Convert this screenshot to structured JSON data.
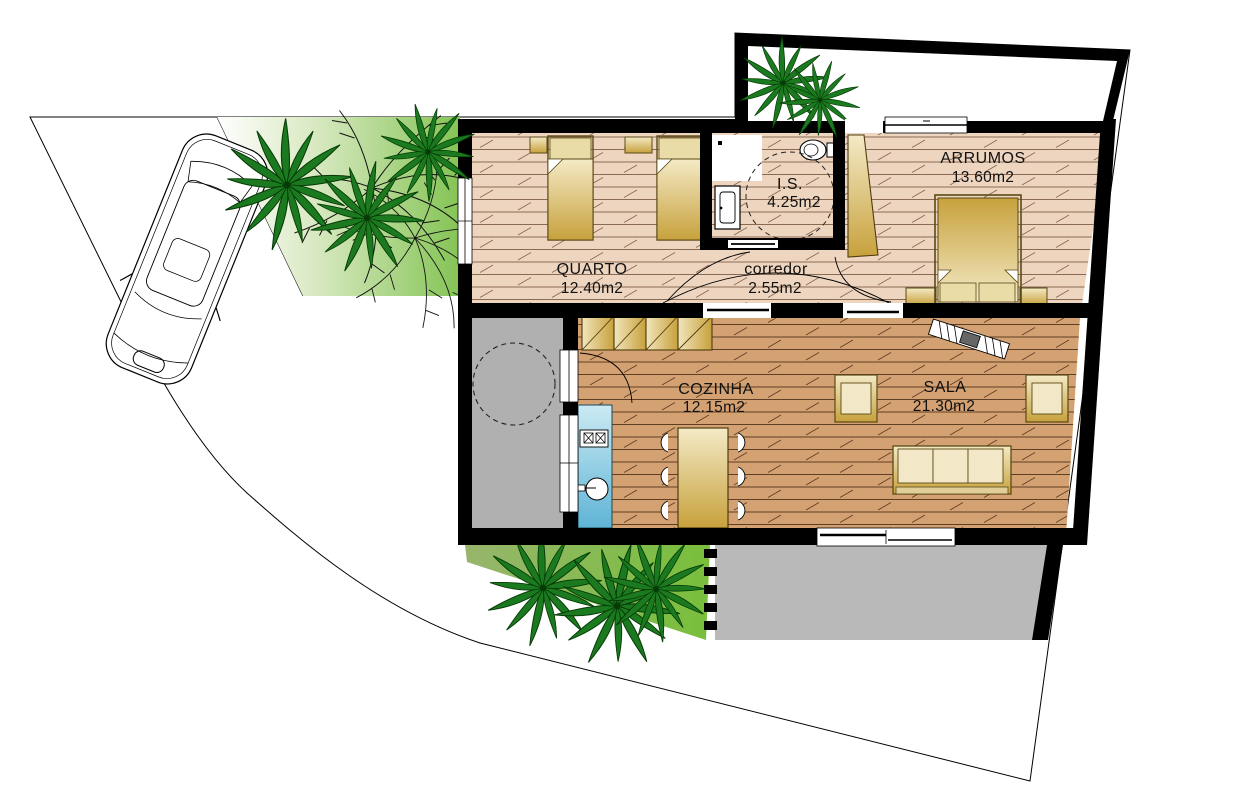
{
  "plan": {
    "type": "architectural-floor-plan",
    "rooms": [
      {
        "id": "quarto",
        "name": "QUARTO",
        "area": "12.40m2"
      },
      {
        "id": "is",
        "name": "I.S.",
        "area": "4.25m2"
      },
      {
        "id": "corredor",
        "name": "corredor",
        "area": "2.55m2"
      },
      {
        "id": "arrumos",
        "name": "ARRUMOS",
        "area": "13.60m2"
      },
      {
        "id": "cozinha",
        "name": "COZINHA",
        "area": "12.15m2"
      },
      {
        "id": "sala",
        "name": "SALA",
        "area": "21.30m2"
      }
    ],
    "colors": {
      "wall": "#000000",
      "floor_bedroom_band": "#EDD5C0",
      "floor_living_band": "#D4A172",
      "furniture_gold": "#C9A23E",
      "counter_blue": "#7FC4DE",
      "patio_gray": "#B0B0B0",
      "terrace_gray": "#B9B9B9",
      "lawn_green": "#7CC23F",
      "palm_green": "#1B7A1F"
    },
    "icons": [
      "car-icon",
      "palm-tree-icon",
      "bare-tree-icon",
      "toilet-icon",
      "washbasin-icon",
      "stove-icon",
      "sink-icon",
      "single-bed",
      "double-bed",
      "wardrobe",
      "dining-table",
      "sofa",
      "armchair",
      "door-leaf",
      "sliding-door",
      "window",
      "turning-circle"
    ]
  }
}
